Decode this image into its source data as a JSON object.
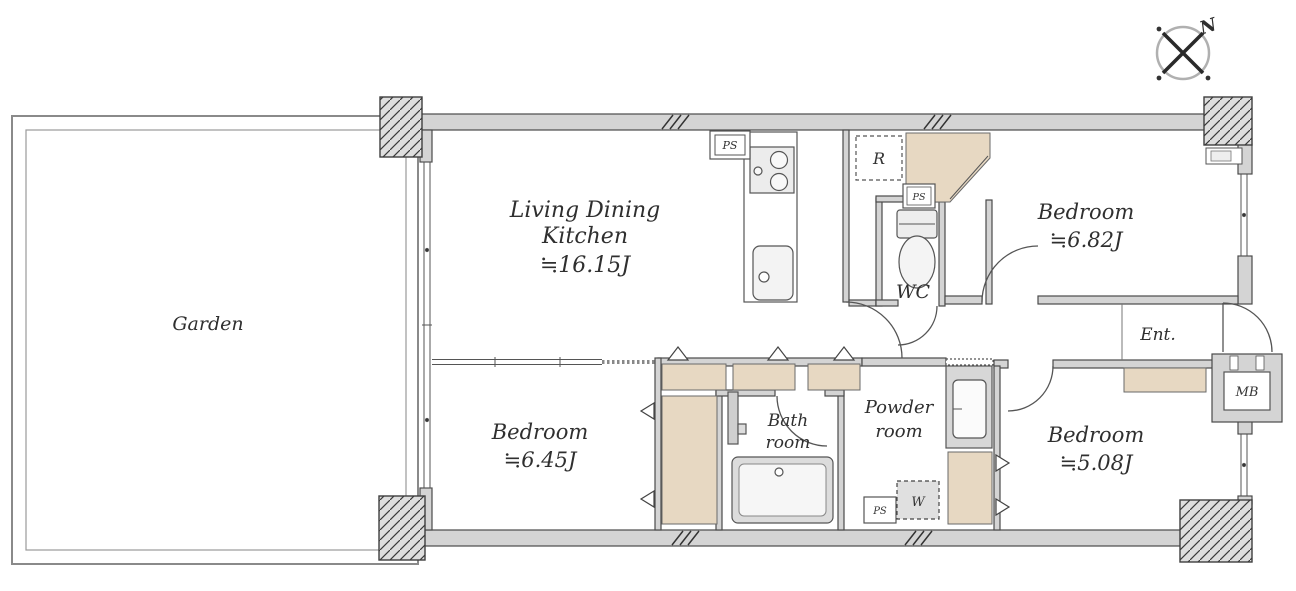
{
  "compass": {
    "north_label": "N"
  },
  "rooms": {
    "garden": {
      "label": "Garden"
    },
    "ldk": {
      "label_line1": "Living Dining",
      "label_line2": "Kitchen",
      "area": "≒16.15J"
    },
    "bedroom_top_right": {
      "label": "Bedroom",
      "area": "≒6.82J"
    },
    "bedroom_bottom_left": {
      "label": "Bedroom",
      "area": "≒6.45J"
    },
    "bedroom_bottom_right": {
      "label": "Bedroom",
      "area": "≒5.08J"
    },
    "bathroom": {
      "label_line1": "Bath",
      "label_line2": "room"
    },
    "powder_room": {
      "label_line1": "Powder",
      "label_line2": "room"
    },
    "wc": {
      "label": "WC"
    },
    "entrance": {
      "label": "Ent."
    },
    "meter_box": {
      "label": "MB"
    }
  },
  "fixtures": {
    "pipe_space_top": "PS",
    "pipe_space_mid": "PS",
    "pipe_space_bottom": "PS",
    "refrigerator_space": "R",
    "washing_machine_space": "W"
  },
  "colors": {
    "closet_beige": "#e7d8c2",
    "wall_gray": "#d4d4d4",
    "outline": "#4a4a4a",
    "background": "#ffffff"
  }
}
